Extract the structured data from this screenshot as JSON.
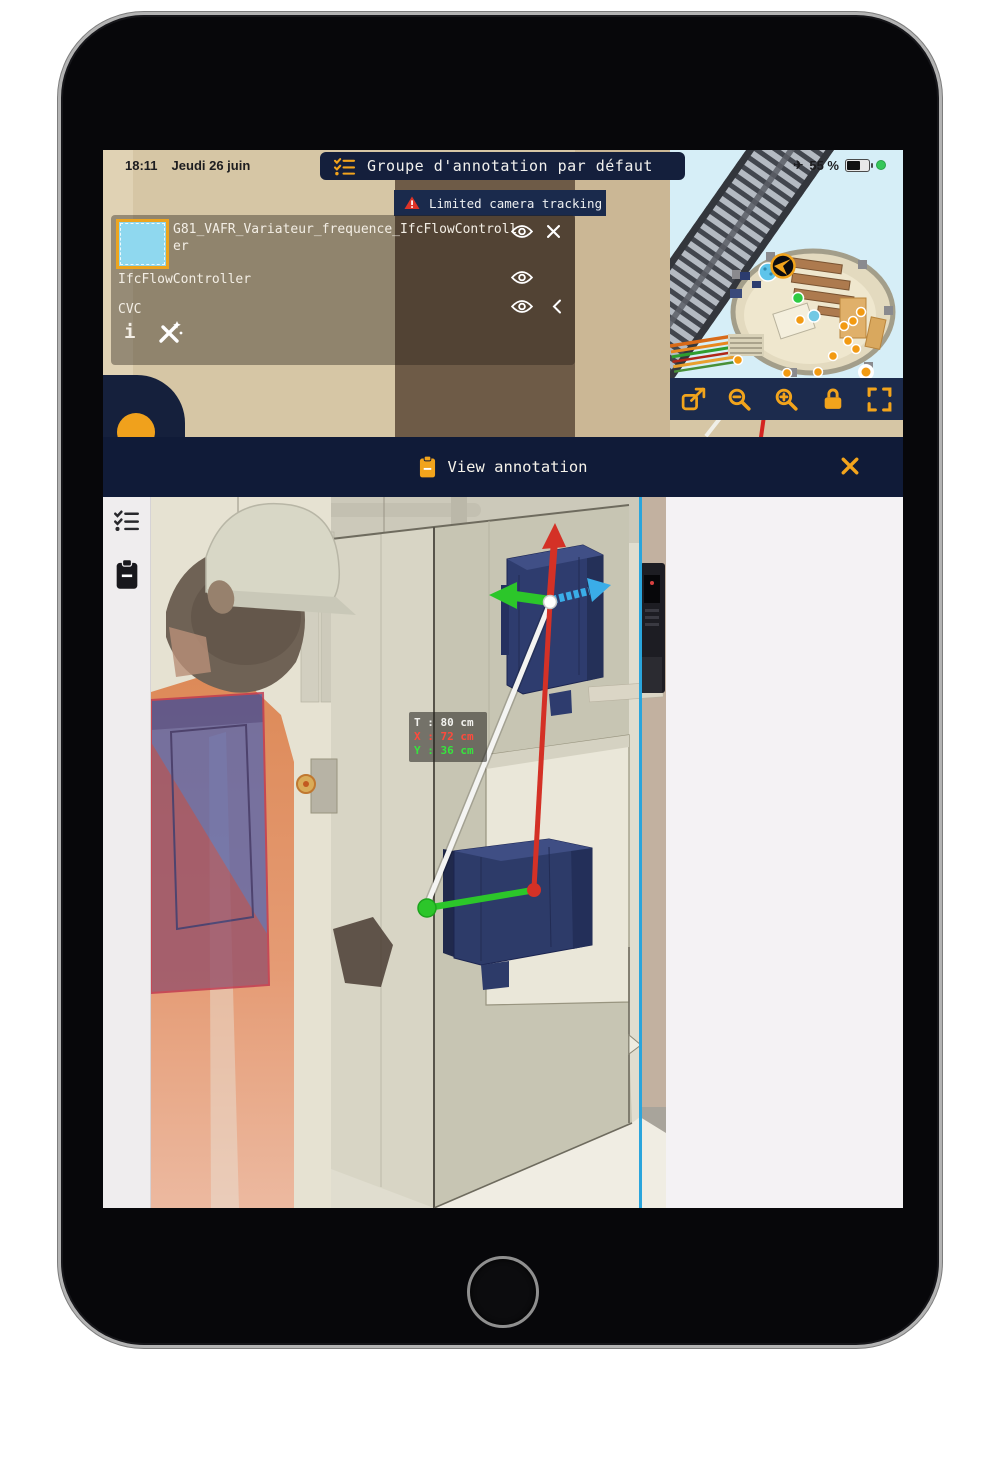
{
  "status_bar": {
    "time": "18:11",
    "date": "Jeudi 26 juin",
    "battery_percent": "55 %"
  },
  "annotation_group_header": {
    "title": "Groupe d'annotation par défaut"
  },
  "tracking_warning": {
    "label": "Limited camera tracking"
  },
  "layers_panel": {
    "selected_color": "#8fd8ef",
    "layers": [
      {
        "label": "G81_VAFR_Variateur_frequence_IfcFlowController"
      },
      {
        "label": "IfcFlowController"
      },
      {
        "label": "CVC"
      }
    ]
  },
  "minimap": {
    "tools": [
      "export",
      "zoom-out",
      "zoom-in",
      "lock",
      "fullscreen"
    ]
  },
  "annotation_bar": {
    "title": "View annotation"
  },
  "ar_view": {
    "measurement": {
      "total": "T : 80 cm",
      "x": "X : 72 cm",
      "y": "Y : 36 cm"
    },
    "axis_colors": {
      "x_red": "#d43126",
      "y_green": "#2cc62a",
      "z_blue": "#3aade8"
    }
  },
  "colors": {
    "accent_orange": "#f0a11c",
    "navy": "#15203d",
    "warning_red": "#dd3327",
    "highlight_blue_line": "#2aa5dc"
  },
  "icons": {
    "airplane": "✈",
    "info": "i"
  }
}
